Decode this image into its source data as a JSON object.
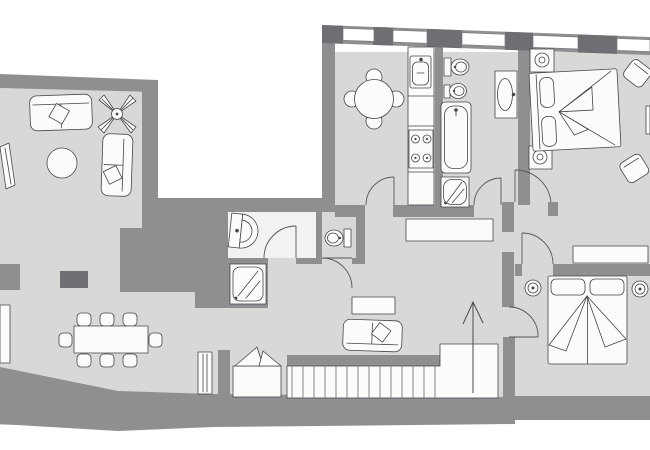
{
  "meta": {
    "type": "floor-plan",
    "description": "Top-down architectural floor plan of an apartment, hand-drawn style, grey walls and light grey floors on white background",
    "text_visible": false,
    "orientation": "landscape"
  },
  "colors": {
    "wall": "#8e8f91",
    "pier": "#6d6f72",
    "floor": "#d8d9d7",
    "fixture": "#fbfbfa",
    "outline": "#46464a",
    "room_white": "#f2f2f1",
    "door": "#55555a",
    "arrow": "#4a4a4e",
    "background": "#ffffff"
  },
  "rooms": [
    {
      "id": "living-room",
      "label": "Living room",
      "position": "top-left",
      "furniture": [
        "two-seat sofa",
        "side sofa",
        "round coffee table",
        "plant",
        "tilted wall shelf"
      ]
    },
    {
      "id": "dining-area",
      "label": "Dining area",
      "position": "bottom-left",
      "furniture": [
        "rectangular dining table",
        "8 chairs",
        "radiator",
        "column",
        "wall column"
      ]
    },
    {
      "id": "kitchen",
      "label": "Kitchen",
      "position": "top-middle",
      "furniture": [
        "round table",
        "4 chairs",
        "counter run",
        "sink",
        "stove with 4 burners"
      ]
    },
    {
      "id": "main-bathroom",
      "label": "Main bathroom",
      "position": "top-middle-right",
      "furniture": [
        "toilet",
        "bidet",
        "bathtub",
        "washbasin",
        "shower"
      ]
    },
    {
      "id": "shower-room",
      "label": "Shower room",
      "position": "center",
      "furniture": [
        "washbasin",
        "shower tray"
      ]
    },
    {
      "id": "wc",
      "label": "WC",
      "position": "center",
      "furniture": [
        "toilet"
      ]
    },
    {
      "id": "hallway",
      "label": "Hallway",
      "position": "center",
      "furniture": [
        "console table"
      ]
    },
    {
      "id": "bedroom-1",
      "label": "Bedroom 1",
      "position": "top-right",
      "furniture": [
        "double bed",
        "2 nightstands with lamps",
        "2 armchairs"
      ]
    },
    {
      "id": "bedroom-2",
      "label": "Bedroom 2",
      "position": "bottom-right",
      "furniture": [
        "double bed",
        "2 bedside lamps",
        "wardrobe"
      ]
    },
    {
      "id": "stair-hall",
      "label": "Stair hall",
      "position": "bottom-middle",
      "furniture": [
        "sofa",
        "side table",
        "straight staircase",
        "winder steps",
        "direction-up arrow"
      ]
    }
  ],
  "counts": {
    "windows": 5,
    "door_swings": 7,
    "dining_chairs": 8,
    "kitchen_chairs": 4,
    "stair_treads": 14,
    "bedrooms": 2,
    "wet_rooms": 3
  },
  "stairs": {
    "direction": "up",
    "arrow": "pointing north"
  }
}
